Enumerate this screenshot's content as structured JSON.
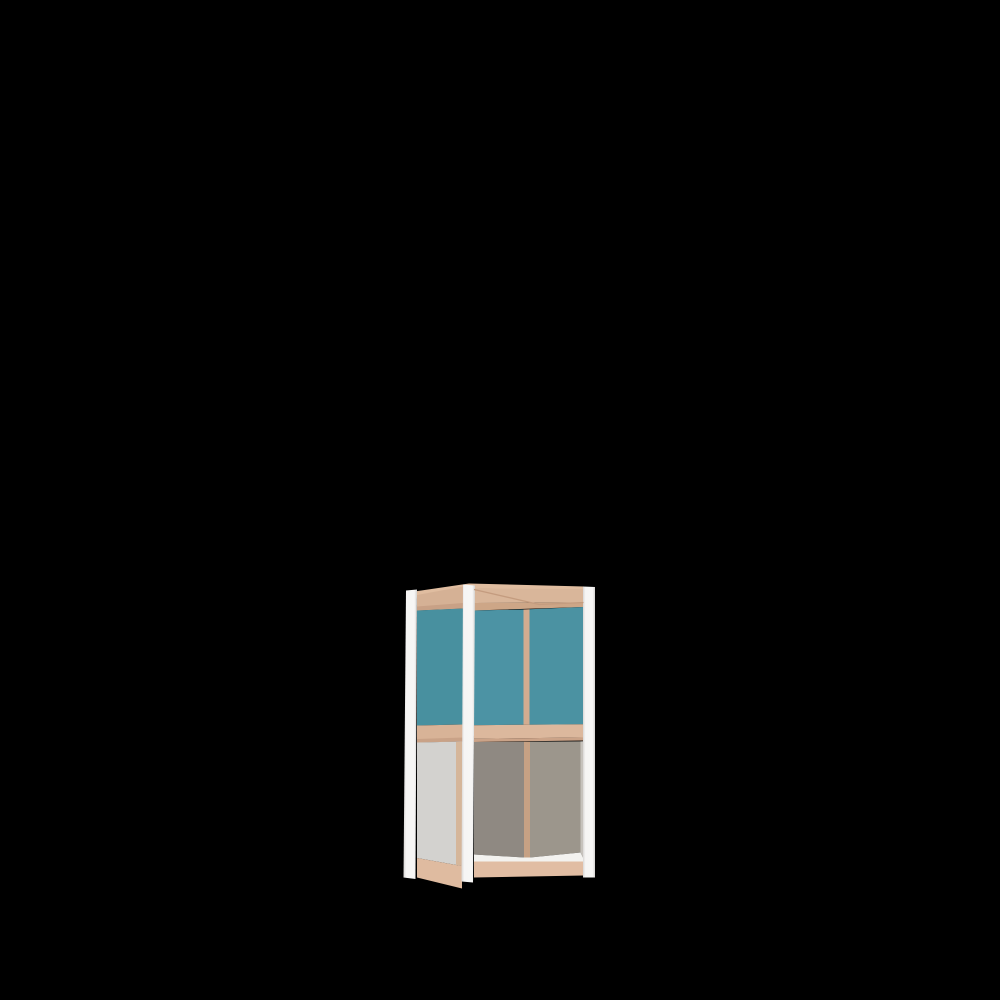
{
  "meta": {
    "subject": "3D product render of a small two-tier storage cabinet frame on a black background",
    "background_color": "#000000",
    "canvas": {
      "width": 1000,
      "height": 1000
    }
  },
  "palette": {
    "background": "#000000",
    "frame_post_white": "#f4f3f1",
    "wood_light": "#dcb89d",
    "wood_top_face": "#e0bda0",
    "wood_chamfer": "#cba388",
    "teal_panel": "#4b92a3",
    "exterior_gray_panel": "#d3d2cf",
    "interior_gray_left": "#8f8982",
    "interior_gray_right": "#9c968c",
    "bottom_deck_white": "#f3f2ef"
  },
  "render": {
    "parts": [
      {
        "name": "top-face-wood",
        "fill": "#e0bda0",
        "points": "411,592 469,583.5 584,586.5 584,590.5 469,588.5 417,597.5"
      },
      {
        "name": "left-top-rail",
        "fill": "#d5b195",
        "points": "417,595 463,586.5 463,608.5 417,610.5"
      },
      {
        "name": "left-top-rail-chamfer",
        "fill": "#c8a186",
        "points": "417,606.5 463,603 463,608.5 417,610.5"
      },
      {
        "name": "left-teal-panel",
        "fill": "#48909f",
        "points": "417,610.5 463,608.5 463,724.5 417,725.5"
      },
      {
        "name": "left-middle-rail",
        "fill": "#d8b397",
        "points": "417,725.5 463,724.5 463,741.5 417,742.5"
      },
      {
        "name": "left-middle-rail-chamfer",
        "fill": "#c9a287",
        "points": "417,739 463,737.5 463,741.5 417,742.5"
      },
      {
        "name": "left-gray-panel",
        "fill": "#d3d2cf",
        "points": "417,742.5 463,741.5 462,866 417,858"
      },
      {
        "name": "left-edge-wood-sliver",
        "fill": "#d5b69a",
        "points": "456,742 462,741.6 462,866 456,864.8"
      },
      {
        "name": "left-bottom-rail",
        "fill": "#dfbba0",
        "points": "417,858 462,866 462,888.5 417,877.5"
      },
      {
        "name": "front-top-rail",
        "fill": "#d9b69a",
        "points": "474,588.5 583.5,589 583.5,602.5 474,603"
      },
      {
        "name": "front-top-rail-chamfer",
        "fill": "#cda687",
        "points": "474,603 583.5,602.5 583.5,607 474,610.5"
      },
      {
        "name": "front-teal-panel-left",
        "fill": "#4c93a4",
        "points": "474,610.5 523.5,609.5 523.5,724.8 474,725.2"
      },
      {
        "name": "front-wood-divider",
        "fill": "#d2ac90",
        "points": "523.5,609.5 529.5,609.3 529.5,724.7 523.5,724.8"
      },
      {
        "name": "front-teal-panel-right",
        "fill": "#4b92a2",
        "points": "529.5,609.3 583.5,607 583.5,724.3 529.5,724.7"
      },
      {
        "name": "front-middle-rail",
        "fill": "#dcb89d",
        "points": "474,725.2 583.5,724.3 583.5,737.5 474,738.8"
      },
      {
        "name": "front-middle-rail-chamfer",
        "fill": "#cba388",
        "points": "474,738.8 583.5,737.5 583.5,740.5 474,742"
      },
      {
        "name": "interior-back-gray-left",
        "fill": "#8f8982",
        "points": "474,742 524,741.8 524,857.5 474,854.5"
      },
      {
        "name": "interior-wood-divider",
        "fill": "#c6a184",
        "points": "524,741.8 530,741.7 530,857.5 524,857.5"
      },
      {
        "name": "interior-back-gray-right",
        "fill": "#9c968c",
        "points": "530,741.7 580.5,741.4 580.5,852.5 530,857.5"
      },
      {
        "name": "interior-right-edge",
        "fill": "#c6c2bc",
        "points": "580.5,741.4 583.5,741.3 583.5,858.5 580.5,852.5"
      },
      {
        "name": "bottom-deck-white",
        "fill": "#f3f2ef",
        "points": "474,854.5 524,857.5 530,857.5 580.5,852.5 583.5,858.5 583.5,861.5 474,861.5"
      },
      {
        "name": "front-bottom-rail",
        "fill": "#e1bda3",
        "points": "474,861.5 583.5,861.5 583.5,875.5 474,877.5"
      },
      {
        "name": "left-post",
        "fill": "#f3f2f1",
        "gradient": "post",
        "points": "406,590.5 417,589.5 415.5,879 403.5,877.5"
      },
      {
        "name": "middle-post",
        "fill": "#f5f4f2",
        "gradient": "post",
        "points": "463,584.5 475,585.5 473,882.5 461.5,881.5"
      },
      {
        "name": "right-post",
        "fill": "#f2f1ef",
        "gradient": "post",
        "points": "583,586.5 595,587 595,877.5 583,877.5"
      }
    ],
    "seams": [
      {
        "name": "top-corner-seam",
        "stroke": "#c49c7f",
        "width": 1.3,
        "points": "474,589.5 539,604.5 583.5,602.5"
      }
    ]
  }
}
